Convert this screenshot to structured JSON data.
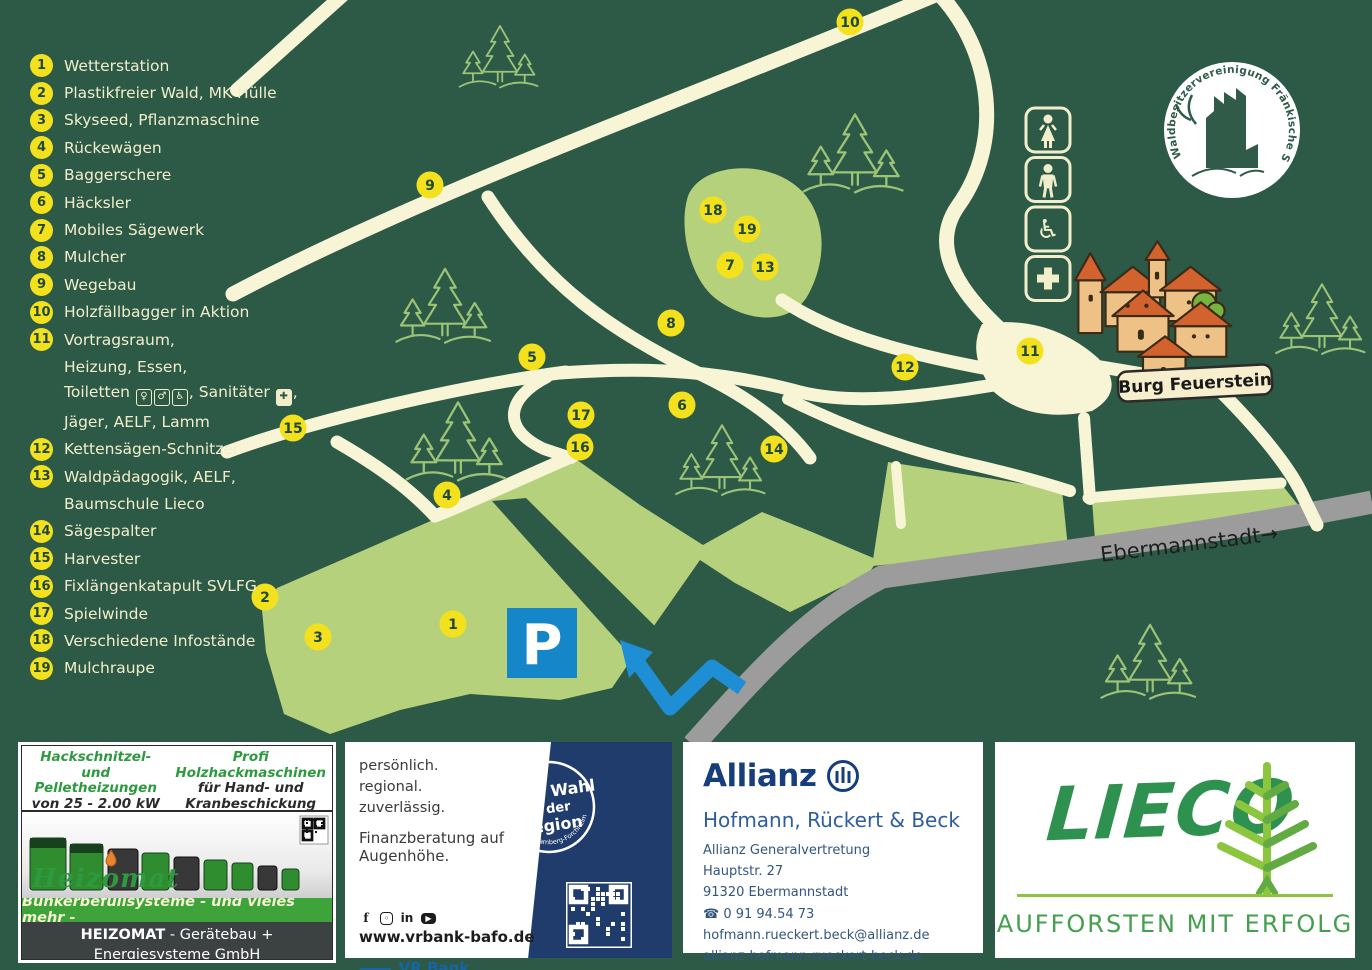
{
  "map": {
    "burg_label": "Burg Feuerstein",
    "road_sign": "Ebermannstadt→",
    "parking_label": "P",
    "logo_ring": "Waldbesitzervereinigung Fränkische Schweiz e.V.",
    "facility_icons": [
      "female-toilet-icon",
      "male-toilet-icon",
      "wheelchair-icon",
      "first-aid-icon"
    ],
    "colors": {
      "background": "#2d5947",
      "road": "#f8f5d6",
      "field": "#b6d17b",
      "marker": "#f4e11d",
      "highway": "#9c9c9c",
      "parking_blue": "#1587c8",
      "arrow_blue": "#1e8fd5"
    },
    "markers": [
      {
        "n": 1,
        "x": 453,
        "y": 624
      },
      {
        "n": 2,
        "x": 265,
        "y": 597
      },
      {
        "n": 3,
        "x": 318,
        "y": 637
      },
      {
        "n": 4,
        "x": 447,
        "y": 495
      },
      {
        "n": 5,
        "x": 532,
        "y": 357
      },
      {
        "n": 6,
        "x": 682,
        "y": 405
      },
      {
        "n": 7,
        "x": 730,
        "y": 265
      },
      {
        "n": 8,
        "x": 671,
        "y": 323
      },
      {
        "n": 9,
        "x": 430,
        "y": 185
      },
      {
        "n": 10,
        "x": 850,
        "y": 22
      },
      {
        "n": 11,
        "x": 1030,
        "y": 351
      },
      {
        "n": 12,
        "x": 905,
        "y": 367
      },
      {
        "n": 13,
        "x": 765,
        "y": 267
      },
      {
        "n": 14,
        "x": 774,
        "y": 449
      },
      {
        "n": 15,
        "x": 293,
        "y": 428
      },
      {
        "n": 16,
        "x": 580,
        "y": 447
      },
      {
        "n": 17,
        "x": 581,
        "y": 415
      },
      {
        "n": 18,
        "x": 713,
        "y": 210
      },
      {
        "n": 19,
        "x": 747,
        "y": 229
      }
    ]
  },
  "legend": {
    "items": [
      {
        "num": 1,
        "lines": [
          "Wetterstation"
        ]
      },
      {
        "num": 2,
        "lines": [
          "Plastikfreier Wald, MK Hülle"
        ]
      },
      {
        "num": 3,
        "lines": [
          "Skyseed, Pflanzmaschine"
        ]
      },
      {
        "num": 4,
        "lines": [
          "Rückewägen"
        ]
      },
      {
        "num": 5,
        "lines": [
          "Baggerschere"
        ]
      },
      {
        "num": 6,
        "lines": [
          "Häcksler"
        ]
      },
      {
        "num": 7,
        "lines": [
          "Mobiles Sägewerk"
        ]
      },
      {
        "num": 8,
        "lines": [
          "Mulcher"
        ]
      },
      {
        "num": 9,
        "lines": [
          "Wegebau"
        ]
      },
      {
        "num": 10,
        "lines": [
          "Holzfällbagger in Aktion"
        ]
      },
      {
        "num": 11,
        "lines": [
          "Vortragsraum,",
          "Heizung, Essen,",
          {
            "segments": [
              {
                "text": "Toiletten "
              },
              {
                "icon": "female-toilet"
              },
              {
                "icon": "male-toilet"
              },
              {
                "icon": "wheelchair"
              },
              {
                "text": ", Sanitäter "
              },
              {
                "icon": "first-aid"
              },
              {
                "text": ","
              }
            ]
          },
          "Jäger, AELF, Lamm"
        ]
      },
      {
        "num": 12,
        "lines": [
          "Kettensägen-Schnitzer"
        ]
      },
      {
        "num": 13,
        "lines": [
          "Waldpädagogik, AELF,",
          "Baumschule Lieco"
        ]
      },
      {
        "num": 14,
        "lines": [
          "Sägespalter"
        ]
      },
      {
        "num": 15,
        "lines": [
          "Harvester"
        ]
      },
      {
        "num": 16,
        "lines": [
          "Fixlängenkatapult SVLFG"
        ]
      },
      {
        "num": 17,
        "lines": [
          "Spielwinde"
        ]
      },
      {
        "num": 18,
        "lines": [
          "Verschiedene Infostände"
        ]
      },
      {
        "num": 19,
        "lines": [
          "Mulchraupe"
        ]
      }
    ]
  },
  "ads": {
    "heizomat": {
      "head_left1": "Hackschnitzel- und",
      "head_left2": "Pelletheizungen",
      "head_left3": "von 25 - 2.00 kW",
      "head_right1": "Profi Holzhackmaschinen",
      "head_right2": "für Hand- und",
      "head_right3": "Kranbeschickung",
      "brand": "Heizomat",
      "bar": "Bunkerbefüllsysteme - und vieles mehr -",
      "footer_bold": "HEIZOMAT",
      "footer_rest": " - Gerätebau + Energiesysteme GmbH",
      "footer_addr": "Maicha 21  91710 Gunzenhausen",
      "footer_contact": "info@heizomat.de  www.heizomat.de"
    },
    "vrbank": {
      "line1": "persönlich.",
      "line2": "regional.",
      "line3": "zuverlässig.",
      "tagline": "Finanzberatung auf Augenhöhe.",
      "website": "www.vrbank-bafo.de",
      "badge_line1": "Erste Wahl",
      "badge_line2": "in der",
      "badge_line3": "Region",
      "badge_arc": "VR Bank Bamberg-Forchheim eG",
      "logo_name": "VR Bank",
      "logo_city": "Bamberg-Forchheim"
    },
    "allianz": {
      "brand": "Allianz",
      "agency": "Hofmann, Rückert & Beck",
      "line1": "Allianz Generalvertretung",
      "line2": "Hauptstr. 27",
      "line3": "91320 Ebermannstadt",
      "phone": "0 91 94.54 73",
      "email": "hofmann.rueckert.beck@allianz.de",
      "web": "allianz-hofmann-rueckert-beck.de"
    },
    "lieco": {
      "brand": "LIECO",
      "slogan": "AUFFORSTEN MIT ERFOLG"
    }
  }
}
